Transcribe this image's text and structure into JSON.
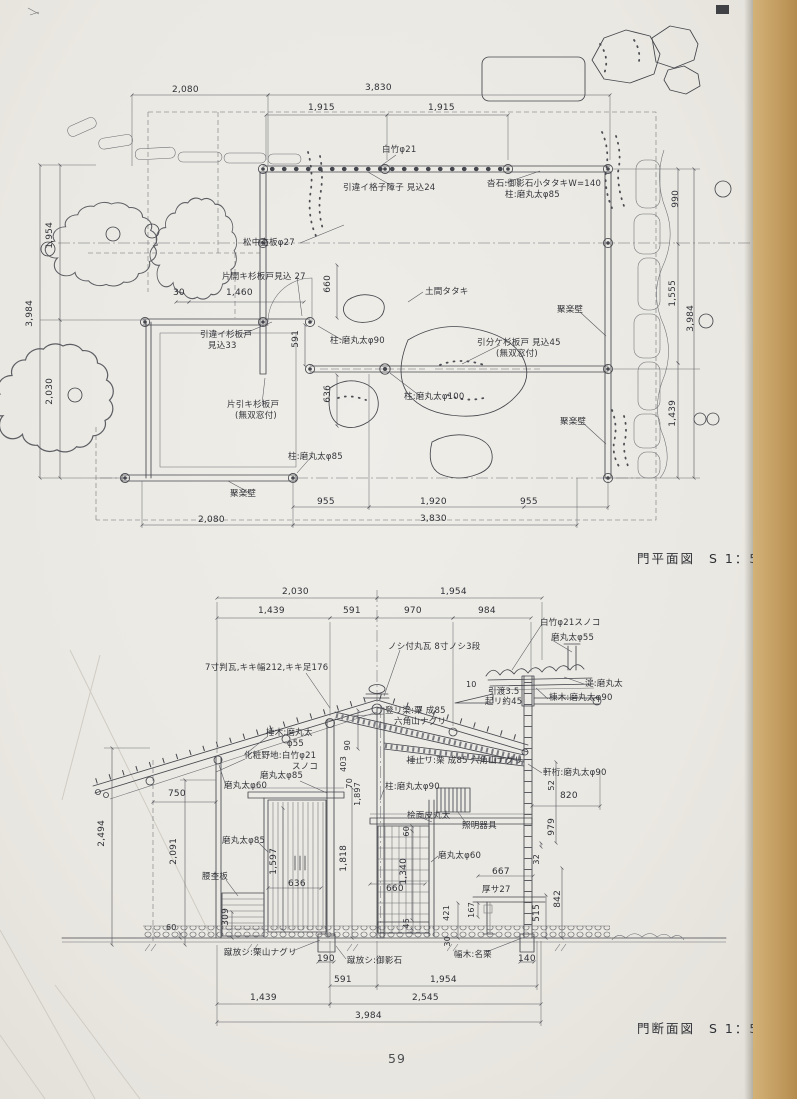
{
  "page": {
    "number": "59",
    "paper_color": "#eae8e3",
    "binding_color": "#c6a166",
    "ink_color": "#44464d"
  },
  "plan": {
    "caption": "門平面図",
    "scale": "S 1：50",
    "dims": [
      "2,080",
      "3,830",
      "1,915",
      "1,915",
      "990",
      "1,555",
      "3,984",
      "1,439",
      "1,954",
      "3,984",
      "2,030",
      "30",
      "1,460",
      "660",
      "591",
      "636",
      "955",
      "1,920",
      "955",
      "2,080",
      "3,830"
    ],
    "labels": [
      "白竹φ21",
      "引違イ格子障子 見込24",
      "沓石:御影石小タタキW=140",
      "柱:磨丸太φ85",
      "松中杢板φ27",
      "片開キ杉板戸見込 27",
      "土間タタキ",
      "引違イ杉板戸",
      "見込33",
      "柱:磨丸太φ90",
      "引分ケ杉板戸 見込45",
      "(無双窓付)",
      "片引キ杉板戸",
      "(無双窓付)",
      "柱:磨丸太φ100",
      "柱:磨丸太φ85",
      "聚楽壁",
      "聚楽壁",
      "聚楽壁"
    ]
  },
  "section": {
    "caption": "門断面図",
    "scale": "S 1：50",
    "dims": [
      "2,030",
      "1,954",
      "1,439",
      "591",
      "970",
      "984",
      "10",
      "引渡3.5",
      "起リ約45",
      "750",
      "2,494",
      "2,091",
      "90",
      "403",
      "70",
      "1,897",
      "1,818",
      "1,597",
      "636",
      "309",
      "60",
      "60",
      "1,340",
      "660",
      "45",
      "421",
      "167",
      "667",
      "厚サ27",
      "820",
      "52",
      "979",
      "32",
      "842",
      "515",
      "30",
      "190",
      "140",
      "591",
      "1,954",
      "1,439",
      "2,545",
      "3,984"
    ],
    "labels": [
      "ノシ付丸瓦 8寸ノシ3段",
      "7寸判瓦,キキ幅212,キキ足176",
      "白竹φ21スノコ",
      "磨丸太φ55",
      "淀:磨丸太",
      "棟木:磨丸太φ90",
      "棰木:磨丸太",
      "φ55",
      "化粧野地:白竹φ21",
      "スノコ",
      "登リ梁:栗 成85",
      "六角山ナグリ",
      "棰止リ:栗 成85 六角山ナグリ",
      "軒桁:磨丸太φ90",
      "磨丸太φ60",
      "磨丸太φ85",
      "柱:磨丸太φ90",
      "桧面皮丸太",
      "照明器具",
      "磨丸太φ85",
      "磨丸太φ60",
      "腰杢板",
      "蹴放シ:栗山ナグリ",
      "蹴放シ:御影石",
      "幅木:名栗"
    ]
  }
}
